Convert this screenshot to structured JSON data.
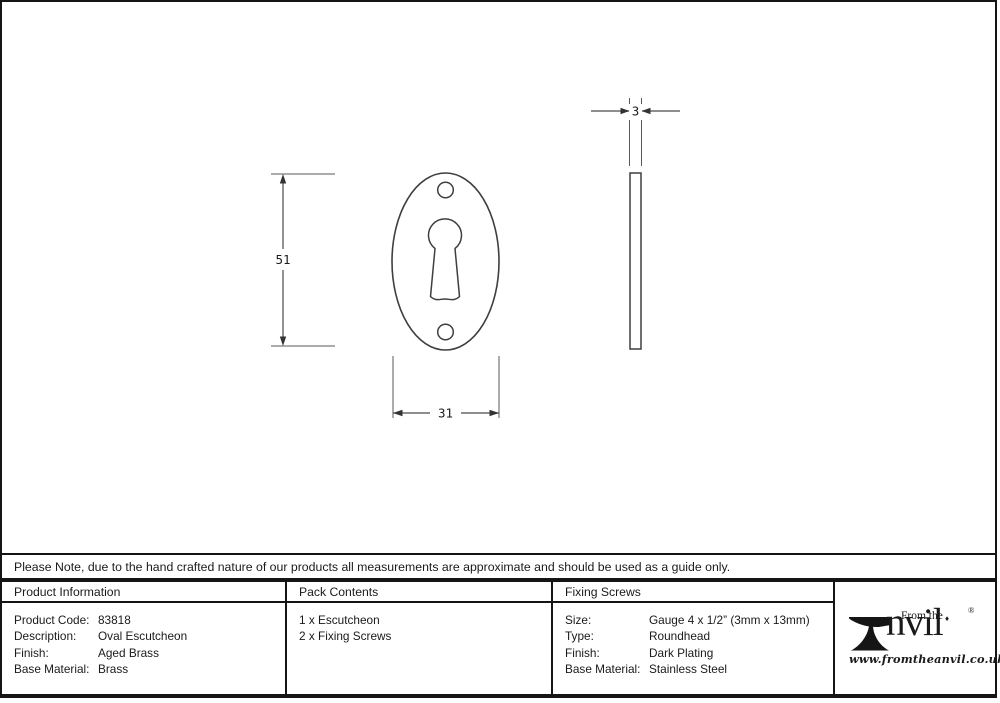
{
  "note": "Please Note, due to the hand crafted nature of our products all measurements are approximate and should be used as a guide only.",
  "drawing": {
    "front_height_mm": "51",
    "front_width_mm": "31",
    "side_thickness_mm": "3"
  },
  "table": {
    "product_info": {
      "header": "Product Information",
      "rows": [
        {
          "label": "Product Code:",
          "value": "83818"
        },
        {
          "label": "Description:",
          "value": "Oval Escutcheon"
        },
        {
          "label": "Finish:",
          "value": "Aged Brass"
        },
        {
          "label": "Base Material:",
          "value": "Brass"
        }
      ]
    },
    "pack_contents": {
      "header": "Pack Contents",
      "lines": [
        "1 x Escutcheon",
        "2 x Fixing Screws"
      ]
    },
    "fixing_screws": {
      "header": "Fixing Screws",
      "rows": [
        {
          "label": "Size:",
          "value": "Gauge 4 x 1/2” (3mm x 13mm)"
        },
        {
          "label": "Type:",
          "value": "Roundhead"
        },
        {
          "label": "Finish:",
          "value": "Dark Plating"
        },
        {
          "label": "Base Material:",
          "value": "Stainless Steel"
        }
      ]
    }
  },
  "brand": {
    "name": "Anvil",
    "from_the": "From the",
    "name_tail": "nvil",
    "i_dot": "♦",
    "registered": "®",
    "url": "www.fromtheanvil.co.uk"
  },
  "colors": {
    "line": "#3f3f3f",
    "border": "#151515",
    "text": "#1a1a1a"
  }
}
